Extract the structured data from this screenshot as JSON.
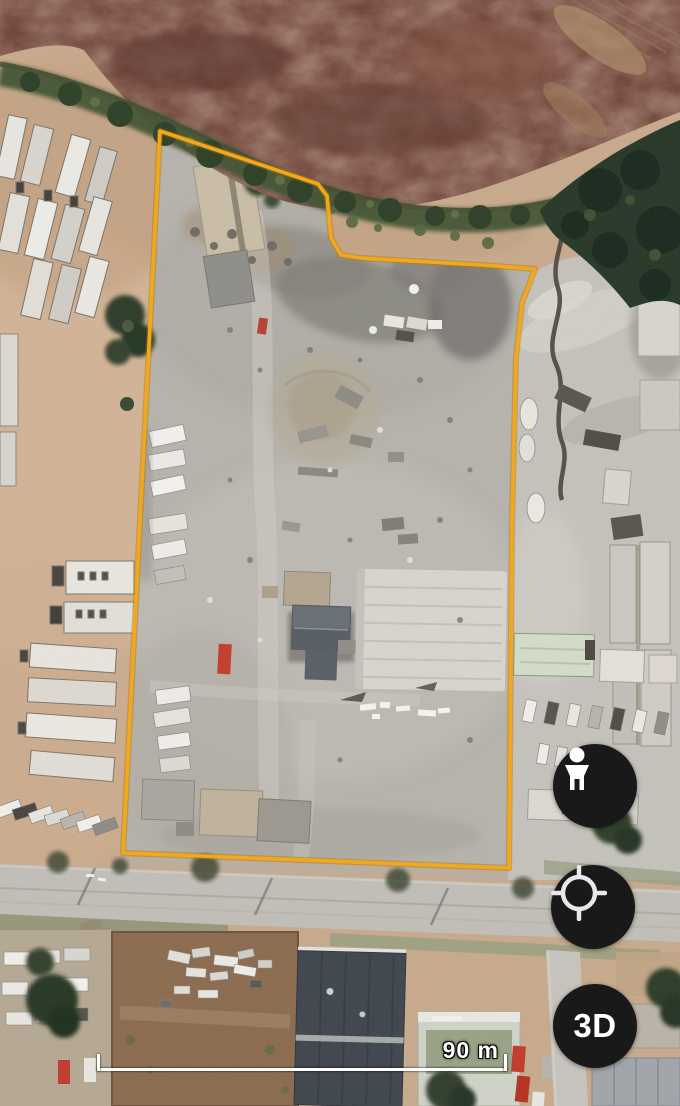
{
  "map": {
    "view": "satellite",
    "boundary": {
      "color": "#f2a81d",
      "points": "160,131 318,184 327,196 331,238 341,255 360,258 481,265 535,269 522,303 516,357 512,520 509,868 123,853"
    },
    "scale_bar": {
      "label": "90 m"
    },
    "controls": {
      "pegman": {
        "icon": "pegman-icon"
      },
      "my_location": {
        "icon": "my-location-icon"
      },
      "three_d": {
        "label": "3D"
      }
    },
    "button_color": "#191919"
  }
}
